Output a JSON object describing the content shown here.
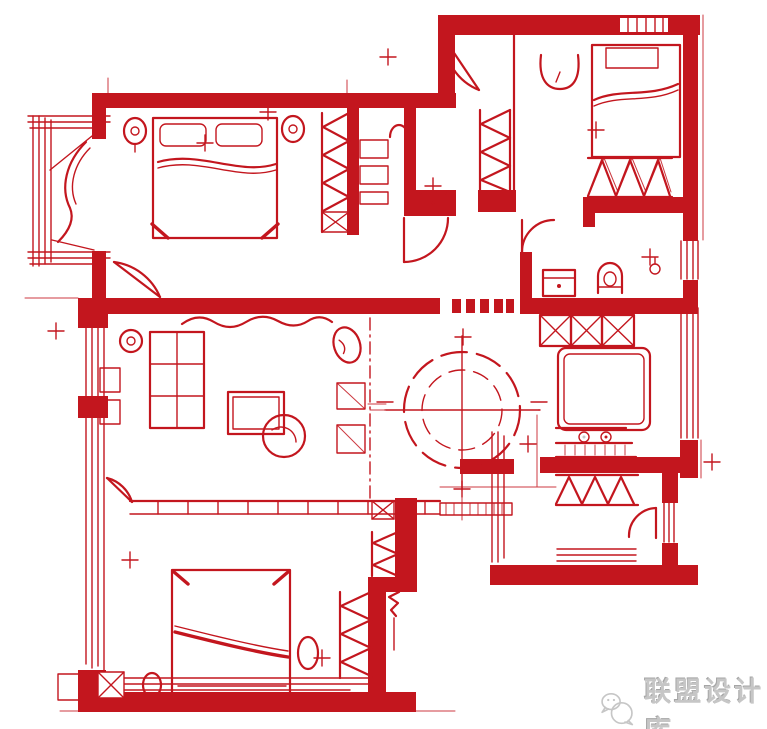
{
  "style": {
    "ink": "#c3161e",
    "bg": "#ffffff",
    "wm": "#c6c6c6",
    "wm_hi": "#ffffff",
    "wm_sh": "#a6a6a6"
  },
  "watermark": {
    "label": "联盟设计库",
    "icon": "chat-bubbles-icon"
  }
}
